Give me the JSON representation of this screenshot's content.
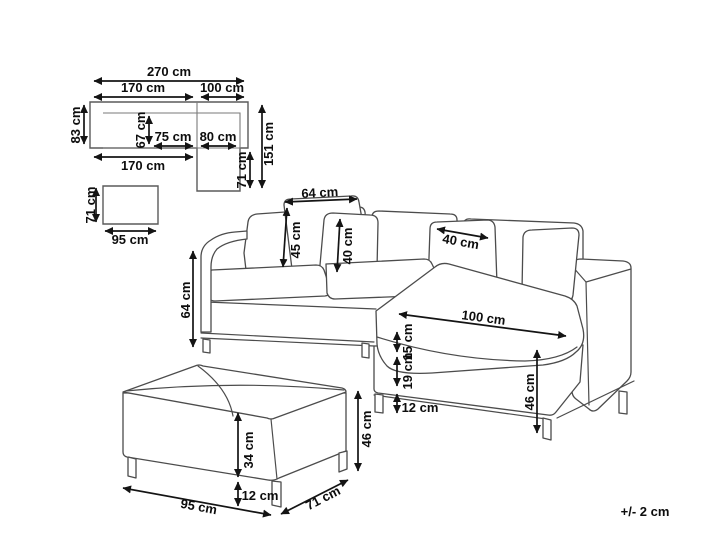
{
  "figure": {
    "tolerance_note": "+/- 2 cm"
  },
  "top_view_sofa": {
    "total_width": "270 cm",
    "left_section_width": "170 cm",
    "chaise_section_width": "100 cm",
    "body_depth": "83 cm",
    "seat_depth": "67 cm",
    "left_seat_width": "75 cm",
    "chaise_seat_width": "80 cm",
    "total_depth": "151 cm",
    "chaise_extension_depth": "71 cm",
    "base_width": "170 cm"
  },
  "top_view_ottoman": {
    "depth": "71 cm",
    "width": "95 cm"
  },
  "sofa": {
    "back_cushion_width": "64 cm",
    "back_cushion_height": "45 cm",
    "throw_pillow_height": "40 cm",
    "throw_pillow_width": "40 cm",
    "armrest_height": "64 cm",
    "chaise_length": "100 cm",
    "seat_cushion_thickness": "15 cm",
    "frame_height": "19 cm",
    "leg_height": "12 cm",
    "total_seat_height": "46 cm"
  },
  "ottoman": {
    "body_height": "34 cm",
    "leg_height": "12 cm",
    "total_height": "46 cm",
    "width": "95 cm",
    "depth": "71 cm"
  }
}
